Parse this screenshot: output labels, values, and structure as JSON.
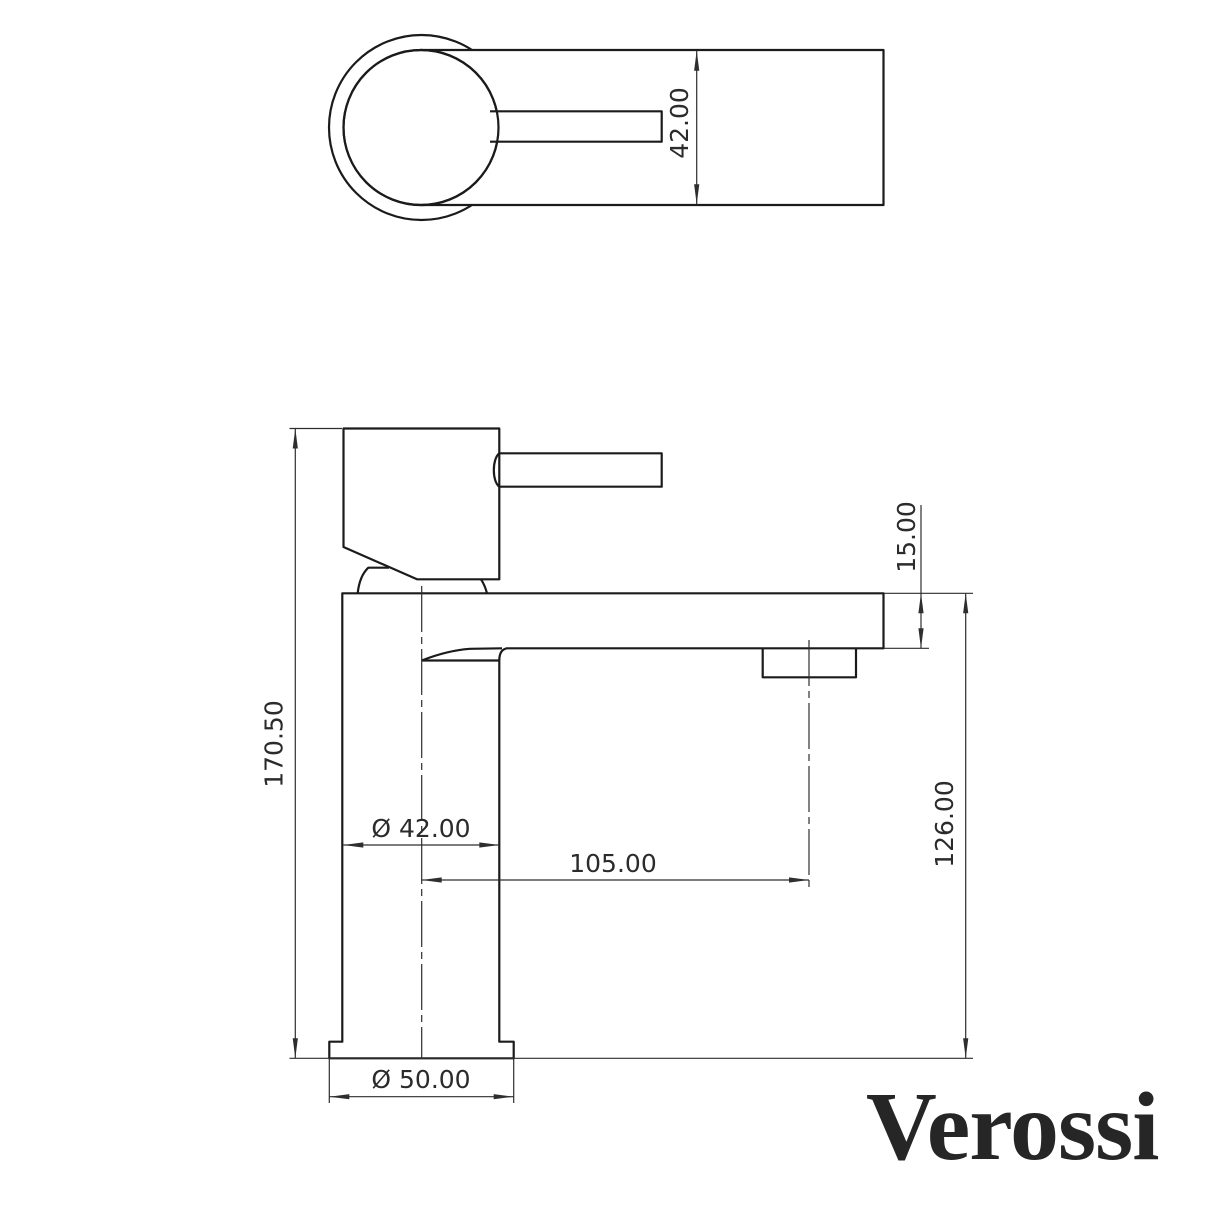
{
  "brand": {
    "logo_text": "Verossi",
    "logo_color": "#262626"
  },
  "drawing": {
    "type": "technical-dimension-drawing",
    "subject": "single-lever basin mixer tap",
    "line_color": "#1b1b1b",
    "dimension_color": "#2e2e2e",
    "views": {
      "top_view": {
        "label": "plan view of tap head and lever"
      },
      "front_view": {
        "label": "front elevation of tap"
      }
    },
    "dimensions": {
      "top_body_width": "42.00",
      "overall_height": "170.50",
      "spout_thickness": "15.00",
      "spout_outlet_height": "126.00",
      "body_diameter": "Ø 42.00",
      "spout_reach": "105.00",
      "base_diameter": "Ø 50.00"
    }
  }
}
